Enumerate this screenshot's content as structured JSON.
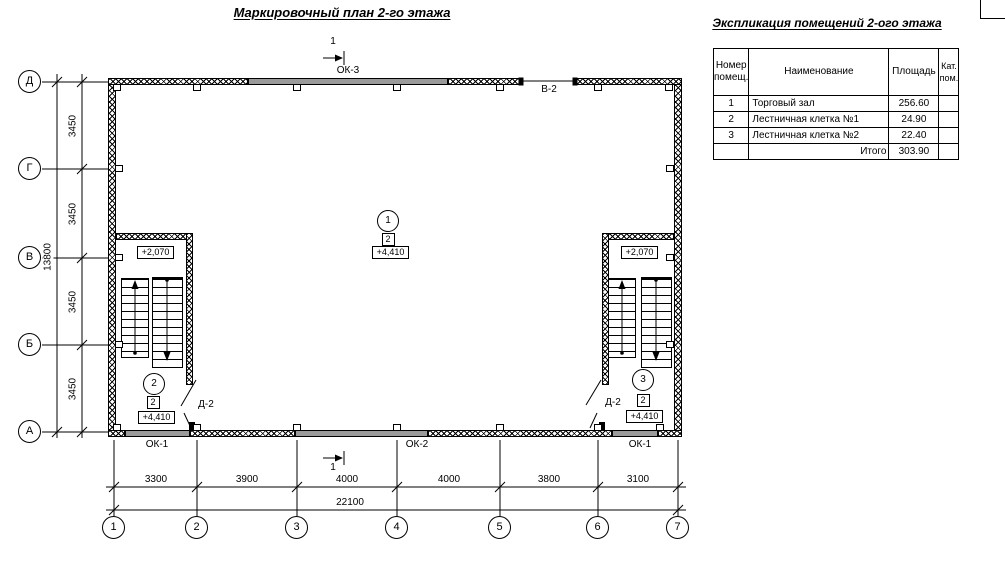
{
  "titles": {
    "main": "Маркировочный план 2-го этажа",
    "table": "Экспликация помещений 2-ого этажа"
  },
  "explication": {
    "headers": [
      "Номер\nпомещ.",
      "Наименование",
      "Площадь",
      "Кат.\nпом."
    ],
    "rows": [
      {
        "num": "1",
        "name": "Торговый зал",
        "area": "256.60",
        "cat": ""
      },
      {
        "num": "2",
        "name": "Лестничная клетка №1",
        "area": "24.90",
        "cat": ""
      },
      {
        "num": "3",
        "name": "Лестничная клетка №2",
        "area": "22.40",
        "cat": ""
      }
    ],
    "total_label": "Итого",
    "total_area": "303.90"
  },
  "axes": {
    "left": [
      "Д",
      "Г",
      "В",
      "Б",
      "А"
    ],
    "bottom": [
      "1",
      "2",
      "3",
      "4",
      "5",
      "6",
      "7"
    ]
  },
  "dims": {
    "left_segments": [
      "3450",
      "3450",
      "3450",
      "3450"
    ],
    "left_total": "13800",
    "bottom_segments": [
      "3300",
      "3900",
      "4000",
      "4000",
      "3800",
      "3100"
    ],
    "bottom_total": "22100"
  },
  "windows": {
    "top": "ОК-3",
    "top_opening": "В-2",
    "bottom_left": "ОК-1",
    "bottom_center": "ОК-2",
    "bottom_right": "ОК-1"
  },
  "section": {
    "top": "1",
    "bottom": "1"
  },
  "markers": {
    "center": {
      "room": "1",
      "cat": "2",
      "elev": "+4,410"
    },
    "left": {
      "room": "2",
      "cat": "2",
      "elev": "+4,410",
      "landing": "+2,070",
      "door": "Д-2"
    },
    "right": {
      "room": "3",
      "cat": "2",
      "elev": "+4,410",
      "landing": "+2,070",
      "door": "Д-2"
    }
  }
}
